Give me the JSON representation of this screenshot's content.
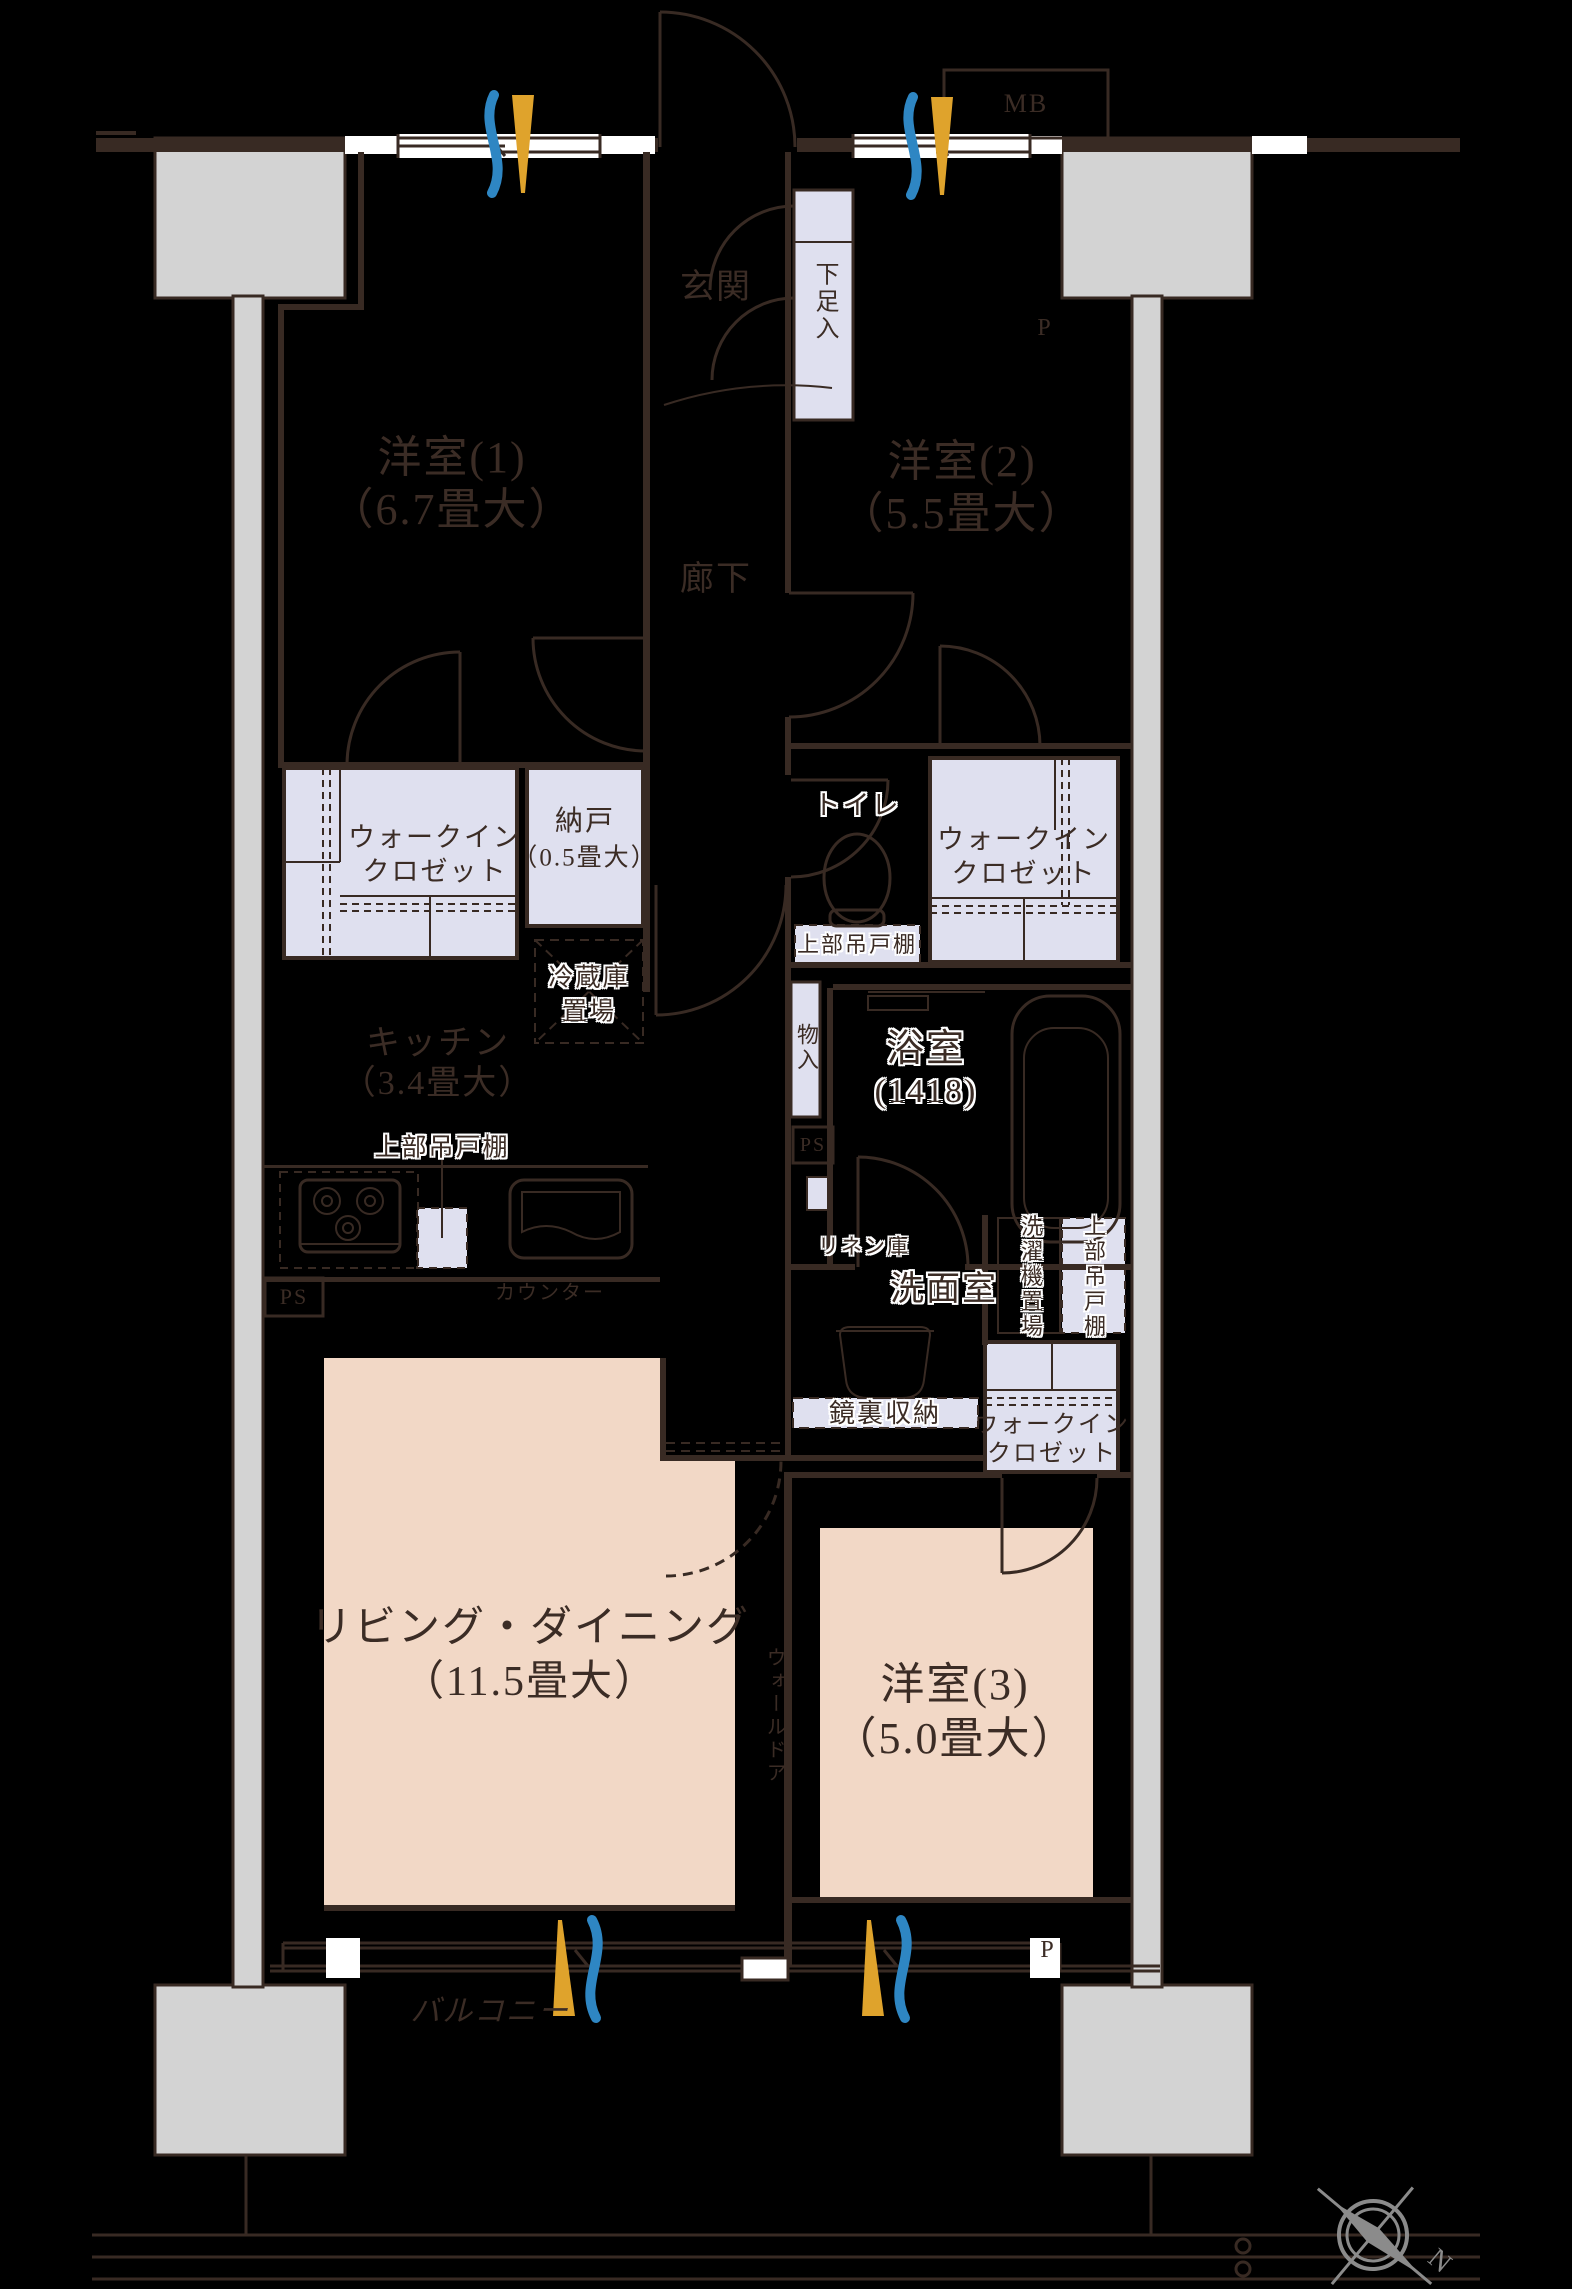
{
  "meta": {
    "type": "apartment-floorplan"
  },
  "colors": {
    "background": "#000000",
    "wall": "#382a23",
    "closet_fill": "#dfe0ef",
    "room_fill": "#f2d8c6",
    "pillar_fill": "#d3d3d3",
    "accent_blue": "#2e86c3",
    "accent_yellow": "#dfa32c",
    "compass_gray": "#8b8b8b",
    "text": "#3b2c25"
  },
  "rooms": {
    "bedroom1": {
      "name": "洋室(1)",
      "size": "（6.7畳大）"
    },
    "bedroom2": {
      "name": "洋室(2)",
      "size": "（5.5畳大）"
    },
    "bedroom3": {
      "name": "洋室(3)",
      "size": "（5.0畳大）"
    },
    "living_dining": {
      "name": "リビング・ダイニング",
      "size": "（11.5畳大）"
    },
    "kitchen": {
      "name": "キッチン",
      "size": "（3.4畳大）"
    },
    "bathroom": {
      "name": "浴室",
      "size": "(1418)"
    },
    "washroom": {
      "name": "洗面室"
    },
    "toilet": {
      "name": "トイレ"
    },
    "entrance": {
      "name": "玄関"
    },
    "hallway": {
      "name": "廊下"
    },
    "storage_nando": {
      "name": "納戸",
      "size": "（0.5畳大）"
    },
    "balcony": {
      "name": "バルコニー"
    }
  },
  "storage": {
    "walk_in_closet": {
      "line1": "ウォークイン",
      "line2": "クロゼット"
    },
    "shoe_cabinet": "下足入",
    "upper_cabinet": "上部吊戸棚",
    "mirror_storage": "鏡裏収納",
    "linen": "リネン庫",
    "closet_small": "物入",
    "refrigerator": {
      "line1": "冷蔵庫",
      "line2": "置場"
    },
    "washer": "洗濯機置場",
    "counter": "カウンター",
    "wall_door": "ウォールドア"
  },
  "labels": {
    "mb": "MB",
    "p": "P",
    "ps": "PS",
    "north": "N"
  }
}
